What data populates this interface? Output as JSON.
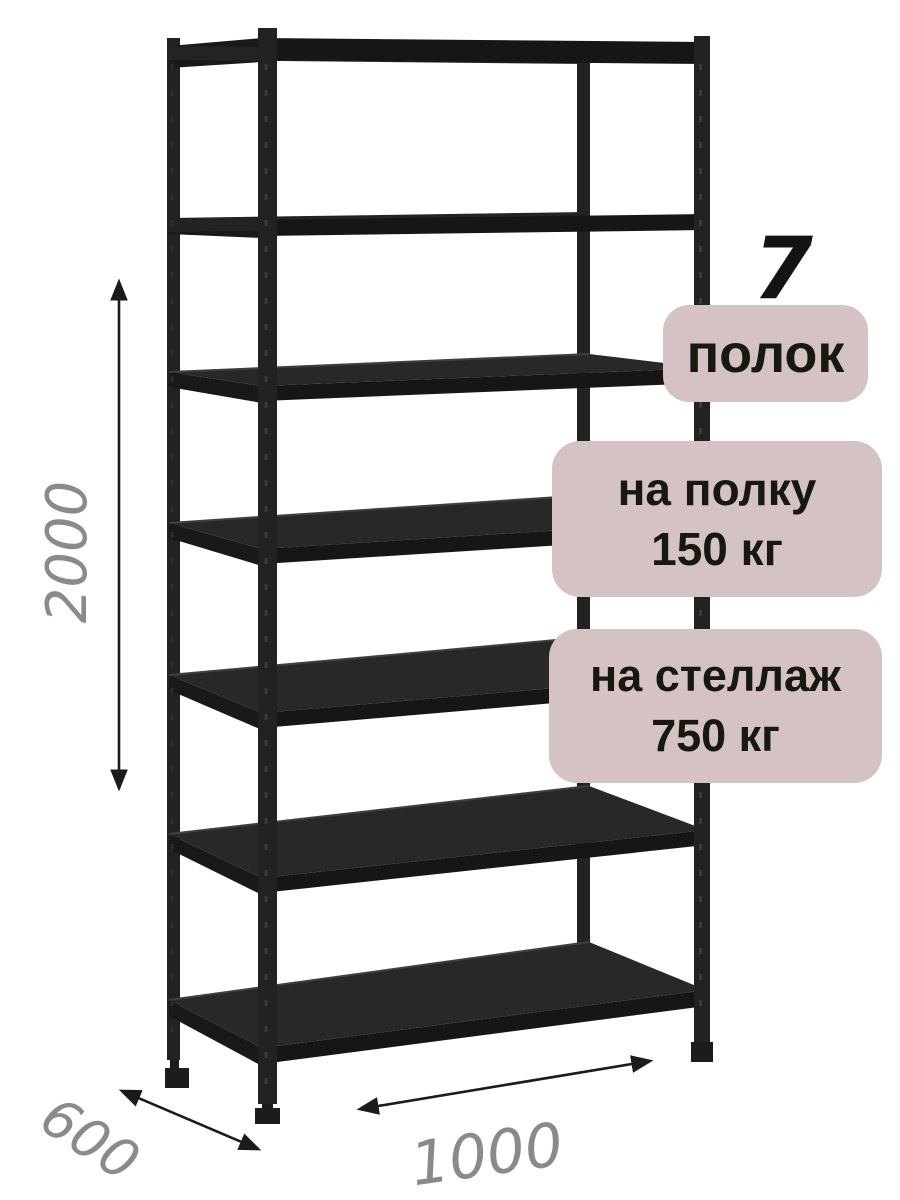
{
  "product_label": {
    "shelf_count_value": "7",
    "shelf_count_unit": "полок",
    "shelf_load_line1": "на полку",
    "shelf_load_line2": "150 кг",
    "rack_load_line1": "на стеллаж",
    "rack_load_line2": "750 кг"
  },
  "dimensions_mm": {
    "height": "2000",
    "depth": "600",
    "width": "1000"
  },
  "rack": {
    "shelves_count": 7,
    "posts_count": 4,
    "finish": "black"
  },
  "colors": {
    "background": "#ffffff",
    "badge_bg": "#d5c2c4",
    "badge_text": "#16190f",
    "dimension_text": "#8a8a8a",
    "arrow": "#1b1b1b",
    "rack_body": "#282828",
    "rack_beam": "#232323",
    "rack_front": "#161616",
    "rack_side": "#191919",
    "rack_post": "#222222",
    "rack_foot": "#1c1c1c",
    "rack_edge_highlight": "#3f3f3f",
    "rack_perforation": "#3b3b3b"
  }
}
